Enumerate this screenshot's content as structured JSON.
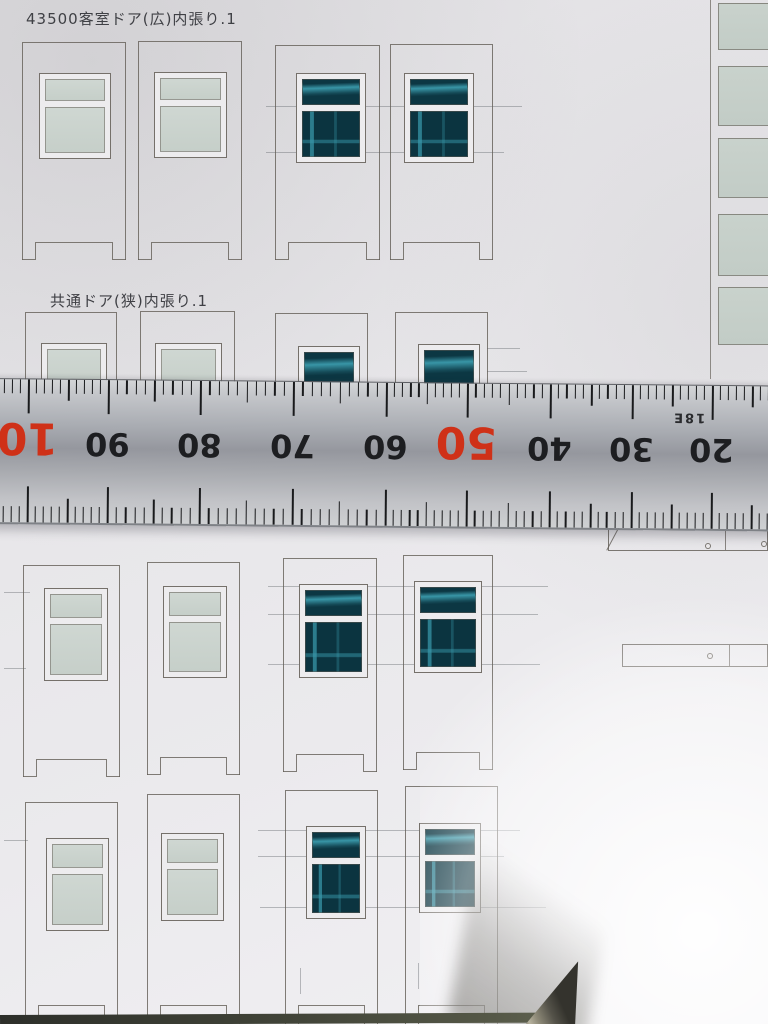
{
  "photo": {
    "sheet_labels": {
      "section1": "43500客室ドア(広)内張り.1",
      "section2": "共通ドア(狭)内張り.1"
    },
    "ruler": {
      "orientation": "upside-down",
      "numbers": [
        {
          "text": "10",
          "x": 28,
          "red": true
        },
        {
          "text": "90",
          "x": 108,
          "red": false
        },
        {
          "text": "80",
          "x": 200,
          "red": false
        },
        {
          "text": "70",
          "x": 293,
          "red": false
        },
        {
          "text": "60",
          "x": 386,
          "red": false
        },
        {
          "text": "50",
          "x": 467,
          "red": true
        },
        {
          "text": "40",
          "x": 550,
          "red": false
        },
        {
          "text": "30",
          "x": 632,
          "red": false
        },
        {
          "text": "20",
          "x": 712,
          "red": false
        }
      ],
      "side_marking": {
        "text": "18E"
      },
      "colors": {
        "number": "#1d1e21",
        "red_number": "#cf3118",
        "body": "#a8abb1",
        "tick": "#191a1c"
      }
    },
    "door_rows": [
      {
        "name": "row1-wide-doors",
        "notch": "full",
        "doors": [
          {
            "x": 22,
            "y": 42,
            "w": 104,
            "h": 218,
            "win": {
              "x": 16,
              "y": 30,
              "w": 72,
              "h": 86,
              "split": true,
              "topH": 22
            },
            "glass": "light"
          },
          {
            "x": 138,
            "y": 41,
            "w": 104,
            "h": 219,
            "win": {
              "x": 15,
              "y": 30,
              "w": 73,
              "h": 86,
              "split": true,
              "topH": 22
            },
            "glass": "light"
          },
          {
            "x": 275,
            "y": 45,
            "w": 105,
            "h": 215,
            "win": {
              "x": 20,
              "y": 27,
              "w": 70,
              "h": 90,
              "split": true,
              "topH": 26
            },
            "glass": "teal"
          },
          {
            "x": 390,
            "y": 44,
            "w": 103,
            "h": 216,
            "win": {
              "x": 13,
              "y": 28,
              "w": 70,
              "h": 90,
              "split": true,
              "topH": 26
            },
            "glass": "teal"
          }
        ]
      },
      {
        "name": "row2-narrow-door-tops",
        "notch": "none",
        "doors": [
          {
            "x": 25,
            "y": 312,
            "w": 92,
            "h": 72,
            "win": {
              "x": 15,
              "y": 30,
              "w": 66,
              "h": 45,
              "split": false
            },
            "glass": "light"
          },
          {
            "x": 140,
            "y": 311,
            "w": 95,
            "h": 73,
            "win": {
              "x": 14,
              "y": 31,
              "w": 67,
              "h": 45,
              "split": false
            },
            "glass": "light"
          },
          {
            "x": 275,
            "y": 313,
            "w": 93,
            "h": 71,
            "win": {
              "x": 22,
              "y": 32,
              "w": 62,
              "h": 42,
              "split": false
            },
            "glass": "teal"
          },
          {
            "x": 395,
            "y": 312,
            "w": 93,
            "h": 72,
            "win": {
              "x": 22,
              "y": 31,
              "w": 62,
              "h": 42,
              "split": false
            },
            "glass": "teal"
          }
        ]
      },
      {
        "name": "row3-doors",
        "notch": "full",
        "doors": [
          {
            "x": 23,
            "y": 565,
            "w": 97,
            "h": 212,
            "win": {
              "x": 20,
              "y": 22,
              "w": 64,
              "h": 93,
              "split": true,
              "topH": 24
            },
            "glass": "light"
          },
          {
            "x": 147,
            "y": 562,
            "w": 93,
            "h": 213,
            "win": {
              "x": 15,
              "y": 23,
              "w": 64,
              "h": 92,
              "split": true,
              "topH": 24
            },
            "glass": "light"
          },
          {
            "x": 283,
            "y": 558,
            "w": 94,
            "h": 214,
            "win": {
              "x": 15,
              "y": 25,
              "w": 69,
              "h": 94,
              "split": true,
              "topH": 26
            },
            "glass": "teal"
          },
          {
            "x": 403,
            "y": 555,
            "w": 90,
            "h": 215,
            "win": {
              "x": 10,
              "y": 25,
              "w": 68,
              "h": 92,
              "split": true,
              "topH": 26
            },
            "glass": "teal"
          }
        ]
      },
      {
        "name": "row4-doors",
        "notch": "openbottom",
        "doors": [
          {
            "x": 25,
            "y": 802,
            "w": 93,
            "h": 224,
            "win": {
              "x": 20,
              "y": 35,
              "w": 63,
              "h": 93,
              "split": true,
              "topH": 24
            },
            "glass": "light"
          },
          {
            "x": 147,
            "y": 794,
            "w": 93,
            "h": 232,
            "win": {
              "x": 13,
              "y": 38,
              "w": 63,
              "h": 88,
              "split": true,
              "topH": 24
            },
            "glass": "light"
          },
          {
            "x": 285,
            "y": 790,
            "w": 93,
            "h": 236,
            "win": {
              "x": 20,
              "y": 35,
              "w": 60,
              "h": 93,
              "split": true,
              "topH": 26
            },
            "glass": "teal"
          },
          {
            "x": 405,
            "y": 786,
            "w": 93,
            "h": 240,
            "win": {
              "x": 13,
              "y": 36,
              "w": 62,
              "h": 90,
              "split": true,
              "topH": 26
            },
            "glass": "teal"
          }
        ]
      }
    ],
    "side_strip": {
      "divider_x": 710,
      "divider_h": 379,
      "rects": {
        "x": 718,
        "w": 54,
        "items": [
          {
            "y": 3,
            "h": 47
          },
          {
            "y": 66,
            "h": 60
          },
          {
            "y": 138,
            "h": 60
          },
          {
            "y": 214,
            "h": 62
          },
          {
            "y": 287,
            "h": 58
          }
        ]
      }
    },
    "thin_parts": [
      {
        "x": 608,
        "y": 517,
        "w": 160,
        "h": 34,
        "seam": 724,
        "holes": [
          {
            "cx": 707,
            "cy": 545
          },
          {
            "cx": 763,
            "cy": 543
          }
        ],
        "chamfer": true
      },
      {
        "x": 622,
        "y": 644,
        "w": 146,
        "h": 23,
        "seam": 728,
        "holes": [
          {
            "cx": 709,
            "cy": 655
          }
        ],
        "chamfer": false
      }
    ],
    "guide_lines": [
      {
        "x": 266,
        "y": 106,
        "w": 256
      },
      {
        "x": 266,
        "y": 152,
        "w": 238
      },
      {
        "x": 487,
        "y": 348,
        "w": 33
      },
      {
        "x": 487,
        "y": 371,
        "w": 40
      },
      {
        "x": 268,
        "y": 586,
        "w": 280
      },
      {
        "x": 268,
        "y": 614,
        "w": 270
      },
      {
        "x": 268,
        "y": 664,
        "w": 272
      },
      {
        "x": 4,
        "y": 592,
        "w": 26
      },
      {
        "x": 4,
        "y": 668,
        "w": 22
      },
      {
        "x": 258,
        "y": 830,
        "w": 262
      },
      {
        "x": 258,
        "y": 856,
        "w": 246
      },
      {
        "x": 260,
        "y": 907,
        "w": 286
      },
      {
        "x": 4,
        "y": 840,
        "w": 24
      },
      {
        "x": 300,
        "y": 968,
        "h": 26,
        "v": true
      },
      {
        "x": 418,
        "y": 963,
        "h": 26,
        "v": true
      }
    ],
    "colors": {
      "paper": "#e9e8eb",
      "outline": "#5f5a52",
      "glass_light": "#cbd3cd",
      "glass_teal": "#0b3440",
      "teal_streak": "#3898aa"
    }
  }
}
